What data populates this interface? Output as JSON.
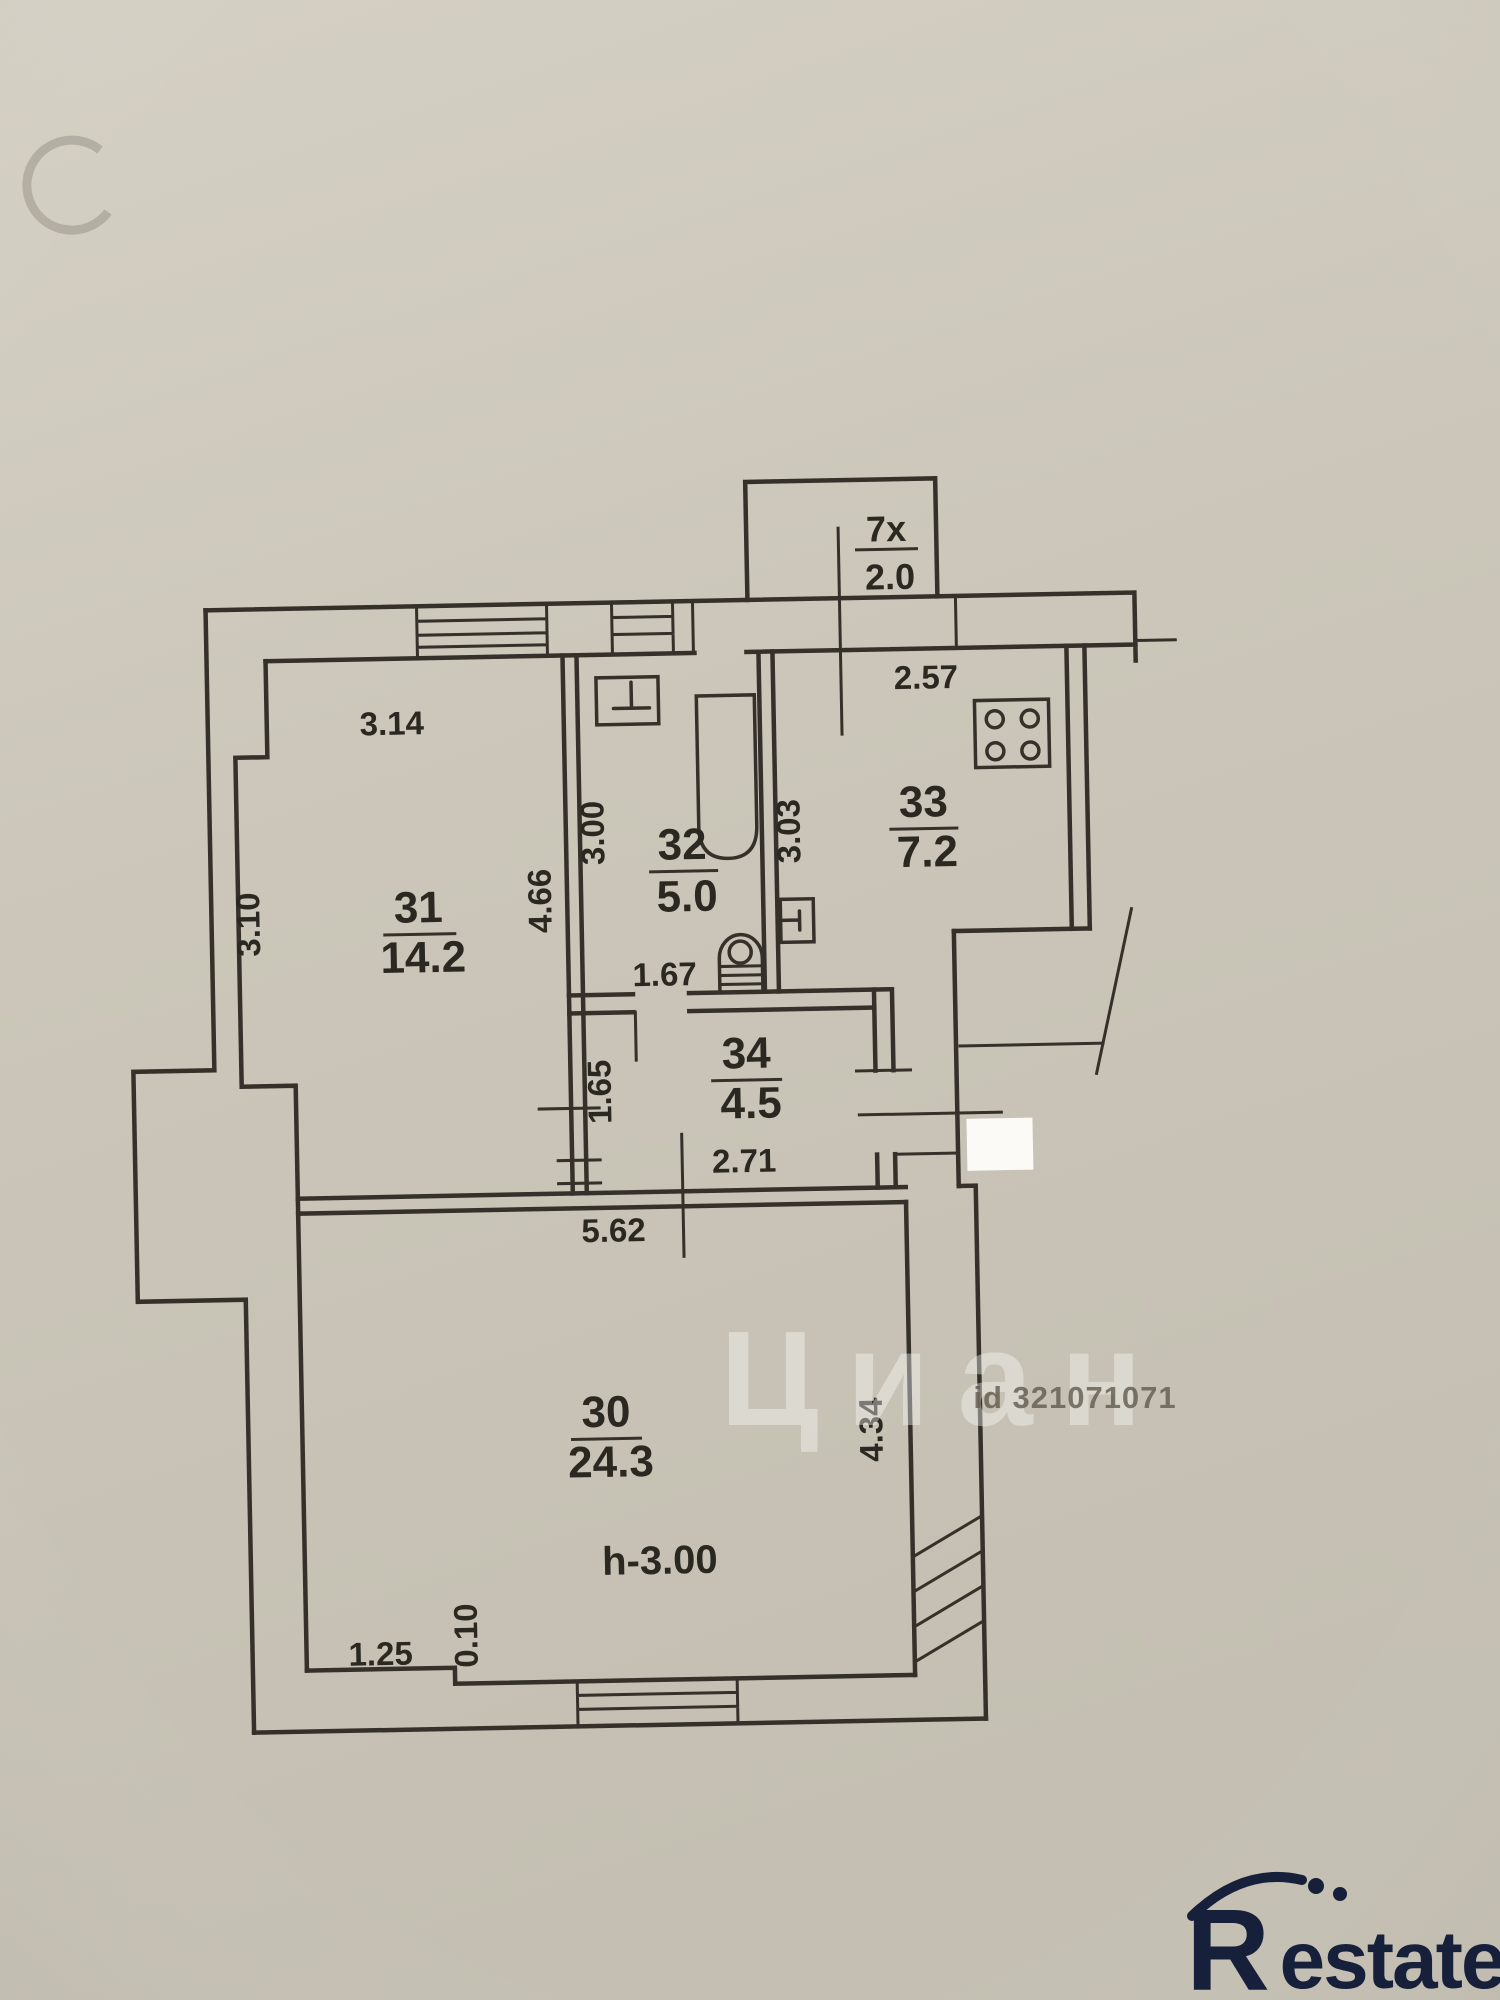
{
  "plan": {
    "balcony": {
      "number": "7x",
      "area": "2.0"
    },
    "rooms": {
      "r30": {
        "number": "30",
        "area": "24.3"
      },
      "r31": {
        "number": "31",
        "area": "14.2"
      },
      "r32": {
        "number": "32",
        "area": "5.0"
      },
      "r33": {
        "number": "33",
        "area": "7.2"
      },
      "r34": {
        "number": "34",
        "area": "4.5"
      }
    },
    "ceiling_height": "h-3.00",
    "dims": {
      "top_room31": "3.14",
      "left_room31": "3.10",
      "room31_depth": "4.66",
      "bath_width": "3.00",
      "bath_bottom": "1.67",
      "kitchen_depth": "3.03",
      "kitchen_top": "2.57",
      "hall_depth": "1.65",
      "hall_width": "2.71",
      "room30_width": "5.62",
      "room30_depth": "4.34",
      "room30_niche": "1.25",
      "room30_step": "0.10"
    }
  },
  "watermarks": {
    "site_name": "Циан",
    "listing_id": "id 321071071",
    "logo_r": "R",
    "logo_rest": "estate"
  },
  "colors": {
    "paper": "#cbc6b9",
    "ink": "#35312a",
    "logo_navy": "#16203a"
  }
}
